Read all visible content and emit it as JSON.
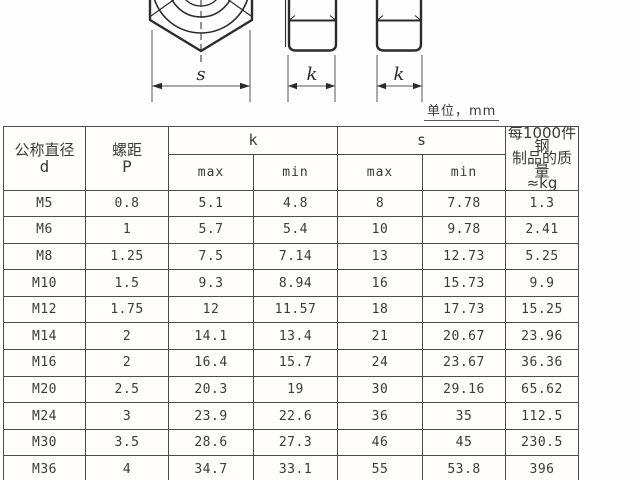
{
  "page": {
    "unit_label": "单位，mm"
  },
  "drawing": {
    "front_view_dim_label": "s",
    "side_view1_dim_label": "k",
    "side_view2_dim_label": "k"
  },
  "colors": {
    "table_border": "#4c4c4c",
    "text": "#3a3a3a",
    "drawing_line": "#2b2b2b",
    "background": "#fefefe"
  },
  "table": {
    "headers": {
      "diameter_cn": "公称直径",
      "diameter_symbol": "d",
      "pitch_cn": "螺距",
      "pitch_symbol": "P",
      "k_group": "k",
      "s_group": "s",
      "weight_line1": "每1000件钢",
      "weight_line2": "制品的质量",
      "weight_line3": "≈kg",
      "max": "max",
      "min": "min"
    },
    "column_keys": [
      "d",
      "p",
      "k-max",
      "k-min",
      "s-max",
      "s-min",
      "weight"
    ],
    "rows": [
      [
        "M5",
        "0.8",
        "5.1",
        "4.8",
        "8",
        "7.78",
        "1.3"
      ],
      [
        "M6",
        "1",
        "5.7",
        "5.4",
        "10",
        "9.78",
        "2.41"
      ],
      [
        "M8",
        "1.25",
        "7.5",
        "7.14",
        "13",
        "12.73",
        "5.25"
      ],
      [
        "M10",
        "1.5",
        "9.3",
        "8.94",
        "16",
        "15.73",
        "9.9"
      ],
      [
        "M12",
        "1.75",
        "12",
        "11.57",
        "18",
        "17.73",
        "15.25"
      ],
      [
        "M14",
        "2",
        "14.1",
        "13.4",
        "21",
        "20.67",
        "23.96"
      ],
      [
        "M16",
        "2",
        "16.4",
        "15.7",
        "24",
        "23.67",
        "36.36"
      ],
      [
        "M20",
        "2.5",
        "20.3",
        "19",
        "30",
        "29.16",
        "65.62"
      ],
      [
        "M24",
        "3",
        "23.9",
        "22.6",
        "36",
        "35",
        "112.5"
      ],
      [
        "M30",
        "3.5",
        "28.6",
        "27.3",
        "46",
        "45",
        "230.5"
      ],
      [
        "M36",
        "4",
        "34.7",
        "33.1",
        "55",
        "53.8",
        "396"
      ]
    ]
  }
}
